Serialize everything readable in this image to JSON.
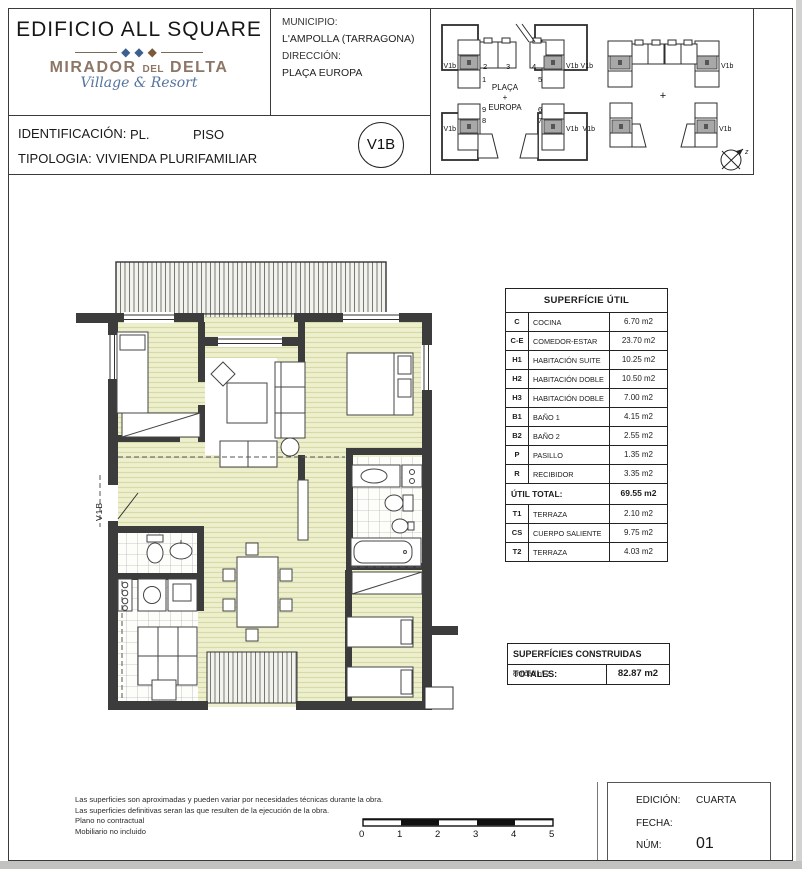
{
  "header": {
    "building_title": "EDIFICIO ALL SQUARE",
    "logo": {
      "word1": "MIRADOR",
      "word2": "DEL",
      "word3": "DELTA",
      "tagline": "Village & Resort",
      "diamond": "◆"
    },
    "municipio_label": "MUNICIPIO:",
    "municipio_value": "L'AMPOLLA (TARRAGONA)",
    "direccion_label": "DIRECCIÓN:",
    "direccion_value": "PLAÇA EUROPA"
  },
  "identification": {
    "id_label": "IDENTIFICACIÓN:",
    "id_value_pl": "PL.",
    "id_value_piso": "PISO",
    "tip_label": "TIPOLOGIA:",
    "tip_value": "VIVIENDA PLURIFAMILIAR",
    "badge": "V1B"
  },
  "site_plan": {
    "unit_label": "V1b",
    "center_line1": "PLAÇA",
    "center_line2": "+",
    "center_line3": "EUROPA",
    "plus": "+",
    "compass_label": "z",
    "numbers": [
      "1",
      "2",
      "3",
      "4",
      "5",
      "6",
      "7",
      "8",
      "9"
    ]
  },
  "floor_plan": {
    "unit_label": "V1B"
  },
  "surface_table": {
    "title": "SUPERFÍCIE ÚTIL",
    "rows": [
      {
        "code": "C",
        "name": "COCINA",
        "area": "6.70 m2"
      },
      {
        "code": "C-E",
        "name": "COMEDOR-ESTAR",
        "area": "23.70 m2"
      },
      {
        "code": "H1",
        "name": "HABITACIÓN SUITE",
        "area": "10.25 m2"
      },
      {
        "code": "H2",
        "name": "HABITACIÓN DOBLE",
        "area": "10.50 m2"
      },
      {
        "code": "H3",
        "name": "HABITACIÓN DOBLE",
        "area": "7.00 m2"
      },
      {
        "code": "B1",
        "name": "BAÑO 1",
        "area": "4.15 m2"
      },
      {
        "code": "B2",
        "name": "BAÑO 2",
        "area": "2.55 m2"
      },
      {
        "code": "P",
        "name": "PASILLO",
        "area": "1.35 m2"
      },
      {
        "code": "R",
        "name": "RECIBIDOR",
        "area": "3.35 m2"
      }
    ],
    "total_label": "ÚTIL TOTAL:",
    "total_value": "69.55 m2",
    "extra_rows": [
      {
        "code": "T1",
        "name": "TERRAZA",
        "area": "2.10 m2"
      },
      {
        "code": "CS",
        "name": "CUERPO SALIENTE",
        "area": "9.75 m2"
      },
      {
        "code": "T2",
        "name": "TERRAZA",
        "area": "4.03 m2"
      }
    ]
  },
  "built_table": {
    "title": "SUPERFÍCIES CONSTRUIDAS TOTALES:",
    "entity_label": "entidad nº 2",
    "entity_value": "82.87 m2"
  },
  "footer": {
    "notes": [
      "Las superficies son aproximadas y pueden variar por necesidades técnicas durante la obra.",
      "Las superficies definitivas seran las que resulten de la ejecución de la obra.",
      "Plano no contractual",
      "Mobiliario no incluido"
    ],
    "scale_ticks": [
      "0",
      "1",
      "2",
      "3",
      "4",
      "5"
    ],
    "edicion_label": "EDICIÓN:",
    "edicion_value": "CUARTA",
    "fecha_label": "FECHA:",
    "num_label": "NÚM:",
    "num_value": "01"
  }
}
